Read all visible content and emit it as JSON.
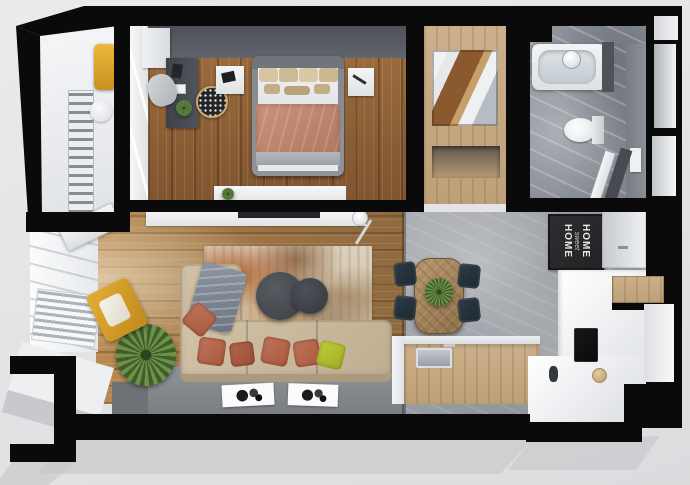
{
  "scene": {
    "description": "Top-down 3D architectural render of a one-bedroom apartment floor plan",
    "background_color": "#e4e4e6",
    "wall_color": "#0a0a0b"
  },
  "home_sign": {
    "line1": "HOME",
    "line2": "sweet",
    "line3": "HOME"
  },
  "palette": {
    "bedroom_wood": "#8a5c33",
    "living_wood": "#a5773f",
    "closet_wood": "#c4a885",
    "concrete_floor": "#9b9ea5",
    "bathroom_marble": "#878c94",
    "bedroom_accent_wall": "#53565c",
    "sofa_beige": "#c9b89c",
    "pillow_terracotta": "#b05f44",
    "pillow_lime": "#b6c234",
    "armchair_yellow": "#dca62f",
    "duvet_terracotta": "#c18873",
    "dining_chair_navy": "#232f3a",
    "coffee_table_charcoal": "#46494f",
    "plant_green": "#4f7136",
    "sign_board": "#2a292c"
  },
  "rooms": [
    "balcony",
    "bedroom",
    "wardrobe",
    "bathroom",
    "living-room",
    "kitchen-dining",
    "entry-hall"
  ]
}
